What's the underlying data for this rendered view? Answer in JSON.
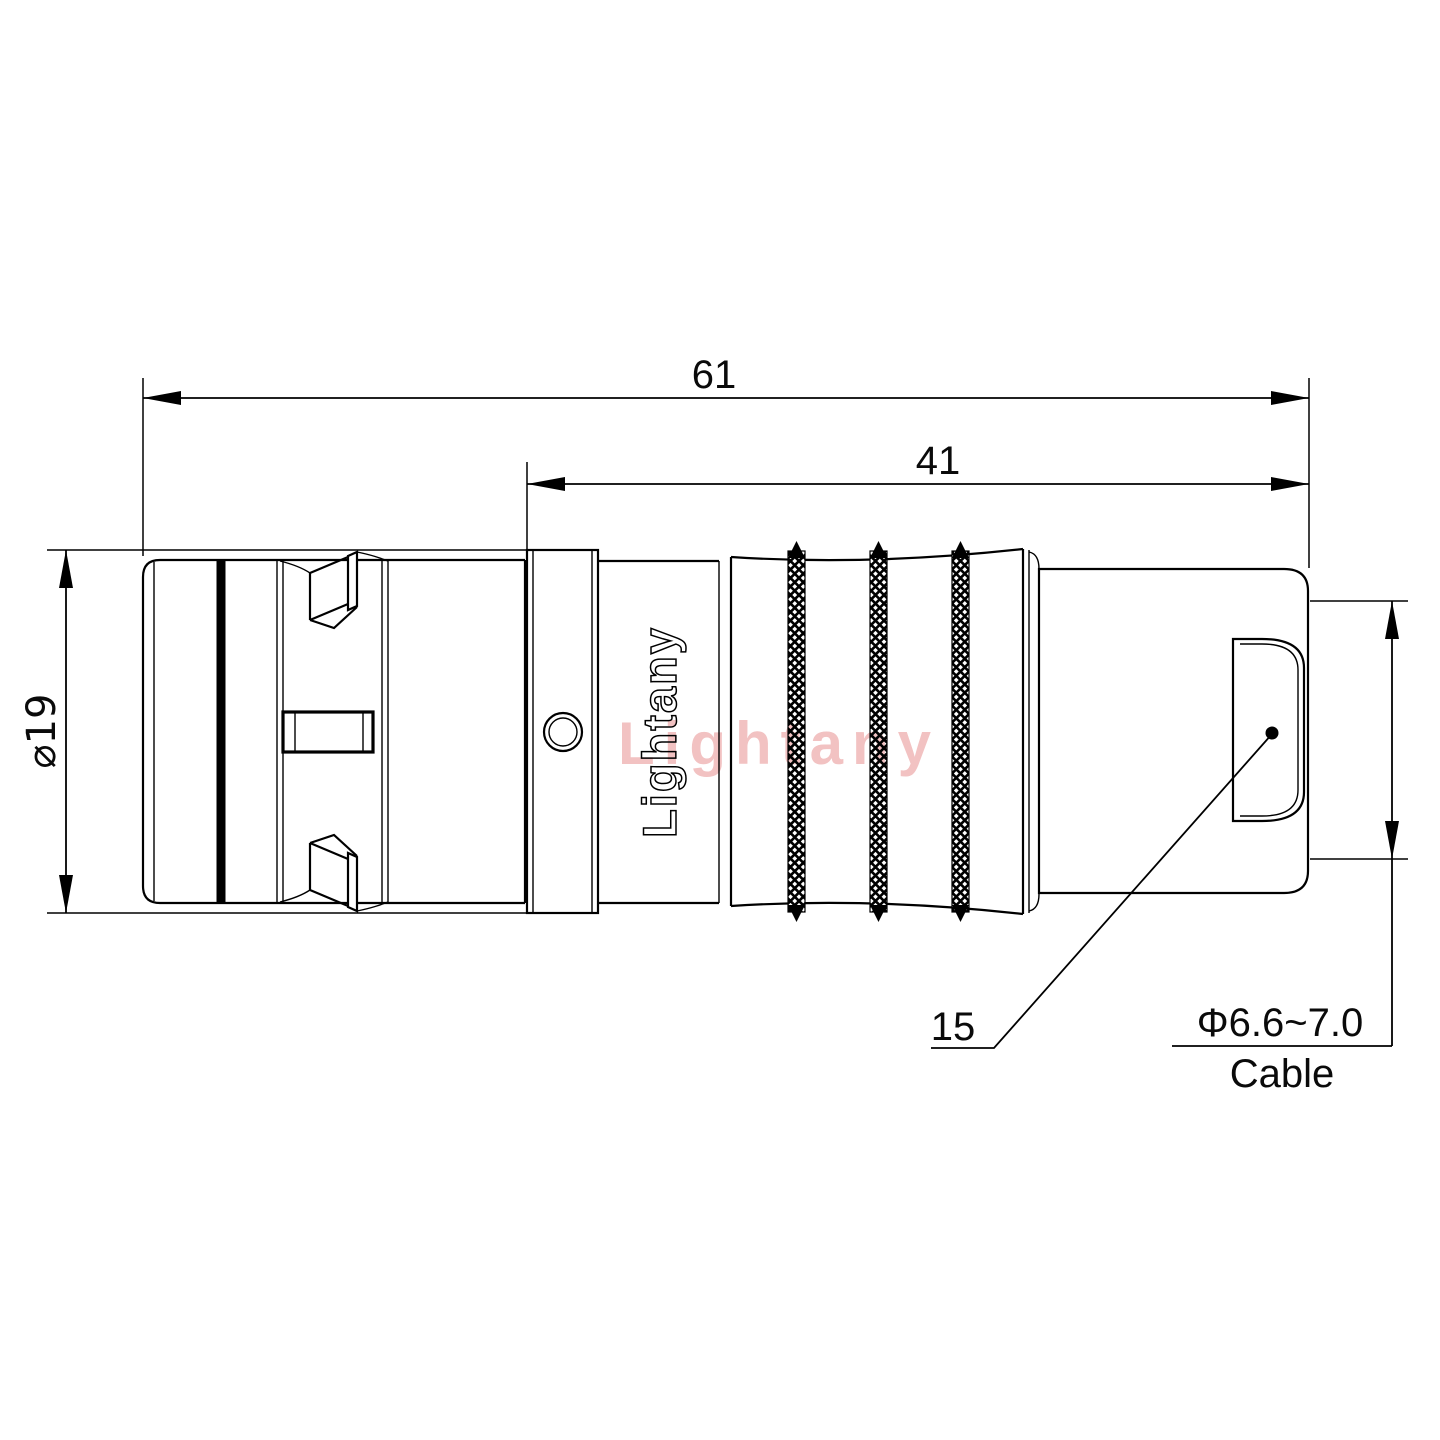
{
  "labels": {
    "dim_overall_length": "61",
    "dim_rear_length": "41",
    "dim_body_diameter": "⌀19",
    "dim_boot_length": "15",
    "dim_cable_diameter": "Φ6.6~7.0",
    "cable_word": "Cable"
  },
  "brand": {
    "engraving": "Lightany",
    "watermark": "Lightany"
  },
  "colors": {
    "line": "#000000",
    "background": "#ffffff",
    "watermark": "#e78f8f"
  }
}
